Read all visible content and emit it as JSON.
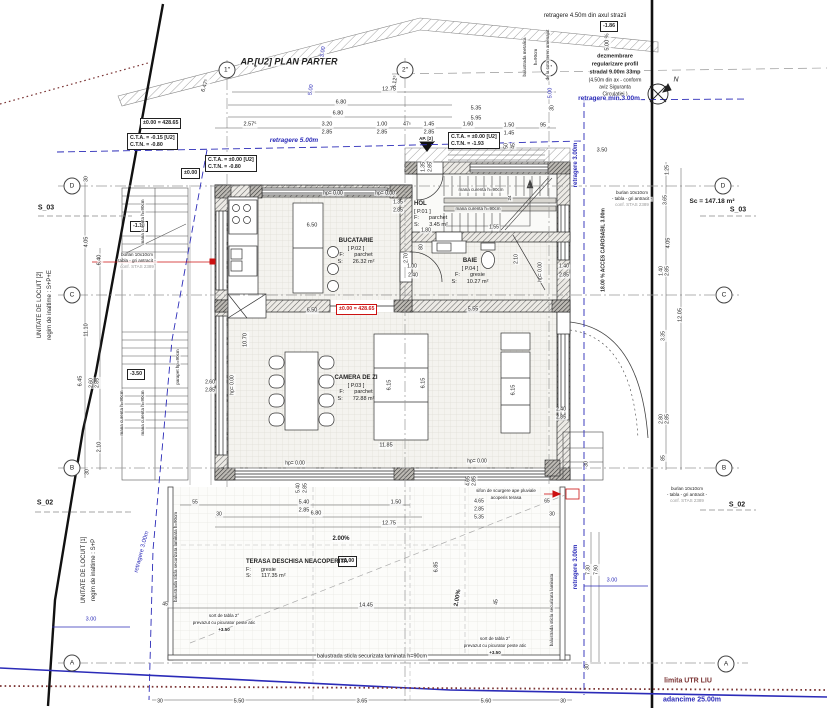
{
  "meta": {
    "width": 827,
    "height": 708
  },
  "colors": {
    "accent_blue": "#2b2bb8",
    "accent_red": "#cc1111",
    "limit_darkred": "#7a3333",
    "ink": "#222222"
  },
  "grid_bubbles": [
    {
      "t": "D",
      "x": 72,
      "y": 186
    },
    {
      "t": "C",
      "x": 72,
      "y": 295
    },
    {
      "t": "B",
      "x": 72,
      "y": 468
    },
    {
      "t": "A",
      "x": 72,
      "y": 663
    },
    {
      "t": "D",
      "x": 723,
      "y": 186
    },
    {
      "t": "C",
      "x": 724,
      "y": 295
    },
    {
      "t": "B",
      "x": 724,
      "y": 468
    },
    {
      "t": "A",
      "x": 726,
      "y": 664
    },
    {
      "t": "1″",
      "x": 227,
      "y": 70
    },
    {
      "t": "2″",
      "x": 405,
      "y": 70
    },
    {
      "t": "3″",
      "x": 549,
      "y": 68
    }
  ],
  "boxes": [
    {
      "x": 140,
      "y": 118,
      "lines": [
        "±0.00 = 428.65"
      ]
    },
    {
      "x": 127,
      "y": 133,
      "lines": [
        "C.T.A. = -0.15 [U2]",
        "C.T.N. = -0.80"
      ]
    },
    {
      "x": 205,
      "y": 155,
      "lines": [
        "C.T.A. = ±0.00 [U2]",
        "C.T.N. = -0.80"
      ]
    },
    {
      "x": 181,
      "y": 168,
      "lines": [
        "±0.00"
      ]
    },
    {
      "x": 448,
      "y": 132,
      "lines": [
        "C.T.A. = ±0.00 [U2]",
        "C.T.N. = -1.93"
      ]
    },
    {
      "x": 600,
      "y": 21,
      "lines": [
        "-1.86"
      ]
    },
    {
      "x": 336,
      "y": 304,
      "lines": [
        "±0.00 = 428.65"
      ],
      "red": true
    },
    {
      "x": 338,
      "y": 556,
      "lines": [
        "±0.00"
      ]
    },
    {
      "x": 130,
      "y": 221,
      "lines": [
        "-1.10"
      ]
    },
    {
      "x": 127,
      "y": 369,
      "lines": [
        "-3.50"
      ]
    }
  ],
  "rooms": [
    {
      "name": "BUCATARIE",
      "code": "[ P.02 ]",
      "f_label": "F:",
      "f_value": "parchet",
      "s_label": "S:",
      "s_value": "26.32 m²",
      "x": 356,
      "y": 238,
      "centered": true
    },
    {
      "name": "HOL",
      "code": "[ P.01 ]",
      "f_label": "F:",
      "f_value": "parchet",
      "s_label": "S:",
      "s_value": "3.45 m²",
      "x": 414,
      "y": 201,
      "centered": false
    },
    {
      "name": "BAIE",
      "code": "[ P.04 ]",
      "f_label": "F:",
      "f_value": "gresie",
      "s_label": "S:",
      "s_value": "10.27 m²",
      "x": 470,
      "y": 258,
      "centered": true
    },
    {
      "name": "CAMERA DE ZI",
      "code": "[ P.03 ]",
      "f_label": "F:",
      "f_value": "parchet",
      "s_label": "S:",
      "s_value": "72.88 m²",
      "x": 356,
      "y": 375,
      "centered": true
    },
    {
      "name": "TERASA DESCHISA NEACOPERITA",
      "code": "",
      "f_label": "F:",
      "f_value": "gresie",
      "s_label": "S:",
      "s_value": "117.35 m²",
      "x": 246,
      "y": 559,
      "centered": false
    }
  ],
  "labels": [
    {
      "t": "AP.[U2] PLAN PARTER",
      "x": 289,
      "y": 62,
      "s": 9,
      "b": 1,
      "i": 1,
      "n": "plan-title"
    },
    {
      "t": "retragere 4.50m din axul strazii",
      "x": 585,
      "y": 16,
      "s": 6,
      "n": "setback-street-label"
    },
    {
      "t": "5.00 %",
      "x": 608,
      "y": 42,
      "r": -90,
      "s": 5.5
    },
    {
      "t": "dezmembrare",
      "x": 615,
      "y": 57,
      "s": 5.5,
      "b": 1,
      "n": "note-dezmembrare"
    },
    {
      "t": "regularizare profil",
      "x": 615,
      "y": 65,
      "s": 5.5,
      "b": 1
    },
    {
      "t": "stradal 9.00m 33mp",
      "x": 615,
      "y": 73,
      "s": 5.5,
      "b": 1
    },
    {
      "t": "(4.50m din ax - conform",
      "x": 615,
      "y": 81,
      "s": 5
    },
    {
      "t": "aviz Siguranta",
      "x": 615,
      "y": 88,
      "s": 5
    },
    {
      "t": "Circulatiei )",
      "x": 615,
      "y": 95,
      "s": 5
    },
    {
      "t": "retragere min.3.00m",
      "x": 609,
      "y": 99,
      "s": 6.5,
      "b": 1,
      "c": "cb",
      "n": "setback-min-label"
    },
    {
      "t": "N",
      "x": 676,
      "y": 80,
      "s": 7,
      "i": 1,
      "n": "north-label"
    },
    {
      "t": "balustrada metalica",
      "x": 525,
      "y": 57,
      "r": -90,
      "s": 4.5
    },
    {
      "t": "h=90cm",
      "x": 536,
      "y": 57,
      "r": -90,
      "s": 4.5
    },
    {
      "t": "de la cota teren amenajat",
      "x": 548,
      "y": 55,
      "r": -90,
      "s": 4.5
    },
    {
      "t": "5.00",
      "x": 551,
      "y": 93,
      "r": -90,
      "s": 5.5,
      "c": "cb"
    },
    {
      "t": "retragere 5.00m",
      "x": 294,
      "y": 141,
      "s": 6.5,
      "b": 1,
      "i": 1,
      "c": "cb",
      "n": "setback-5m-label"
    },
    {
      "t": "6.47⁵",
      "x": 206,
      "y": 86,
      "r": -72,
      "s": 5.5
    },
    {
      "t": "3.00",
      "x": 324,
      "y": 52,
      "r": -80,
      "s": 5.5,
      "c": "cb"
    },
    {
      "t": "5.00",
      "x": 312,
      "y": 90,
      "r": -80,
      "s": 5.5,
      "c": "cb"
    },
    {
      "t": "5.12⁵",
      "x": 396,
      "y": 82,
      "r": -83,
      "s": 5.5
    },
    {
      "t": "12.75",
      "x": 389,
      "y": 90,
      "s": 5.5
    },
    {
      "t": "6.80",
      "x": 341,
      "y": 103,
      "s": 5.5
    },
    {
      "t": "6.80",
      "x": 338,
      "y": 114,
      "s": 5.5
    },
    {
      "t": "5.35",
      "x": 476,
      "y": 109,
      "s": 5.5
    },
    {
      "t": "5.95",
      "x": 476,
      "y": 119,
      "s": 5.5
    },
    {
      "t": "2.57⁵",
      "x": 250,
      "y": 125,
      "s": 5.5
    },
    {
      "t": "3.20",
      "x": 327,
      "y": 125,
      "s": 5.5
    },
    {
      "t": "2.85",
      "x": 327,
      "y": 133,
      "s": 5.5
    },
    {
      "t": "1.00",
      "x": 382,
      "y": 125,
      "s": 5.5
    },
    {
      "t": "2.85",
      "x": 382,
      "y": 133,
      "s": 5.5
    },
    {
      "t": "47⁵",
      "x": 407,
      "y": 125,
      "s": 5
    },
    {
      "t": "1.45",
      "x": 429,
      "y": 125,
      "s": 5.5
    },
    {
      "t": "2.85",
      "x": 429,
      "y": 133,
      "s": 5.5
    },
    {
      "t": "AP. [2]",
      "x": 426,
      "y": 139,
      "s": 4.5,
      "b": 1,
      "n": "entry-label"
    },
    {
      "t": "1.60",
      "x": 468,
      "y": 125,
      "s": 5.5
    },
    {
      "t": "1.50",
      "x": 509,
      "y": 126,
      "s": 5.5
    },
    {
      "t": "1.45",
      "x": 509,
      "y": 134,
      "s": 5.5
    },
    {
      "t": "95",
      "x": 543,
      "y": 126,
      "s": 5.5
    },
    {
      "t": "30",
      "x": 553,
      "y": 108,
      "r": -90,
      "s": 5
    },
    {
      "t": "50",
      "x": 507,
      "y": 146,
      "r": -90,
      "s": 5
    },
    {
      "t": "45",
      "x": 514,
      "y": 146,
      "r": -90,
      "s": 5
    },
    {
      "t": "3.50",
      "x": 602,
      "y": 151,
      "s": 5.5
    },
    {
      "t": "retragere 3.00m",
      "x": 576,
      "y": 165,
      "r": -90,
      "s": 6,
      "b": 1,
      "c": "cb",
      "n": "setback-3m-label"
    },
    {
      "t": "UNITATE DE LOCUIT [2]",
      "x": 40,
      "y": 305,
      "r": -90,
      "s": 6,
      "n": "unit2-label"
    },
    {
      "t": "regim de inaltime : S+P+E",
      "x": 50,
      "y": 305,
      "r": -90,
      "s": 6
    },
    {
      "t": "S_03",
      "x": 46,
      "y": 208,
      "s": 7,
      "b": 1,
      "n": "section-marker"
    },
    {
      "t": "S_02",
      "x": 45,
      "y": 503,
      "s": 7,
      "b": 1,
      "n": "section-marker"
    },
    {
      "t": "UNITATE DE LOCUIT [1]",
      "x": 84,
      "y": 570,
      "r": -90,
      "s": 6,
      "n": "unit1-label"
    },
    {
      "t": "regim de inaltime : S+P",
      "x": 94,
      "y": 570,
      "r": -90,
      "s": 6
    },
    {
      "t": "30",
      "x": 87,
      "y": 179,
      "r": -90,
      "s": 5
    },
    {
      "t": "4.05",
      "x": 87,
      "y": 242,
      "r": -90,
      "s": 5.5
    },
    {
      "t": "6.40",
      "x": 100,
      "y": 260,
      "r": -90,
      "s": 5.5
    },
    {
      "t": "11.10",
      "x": 87,
      "y": 330,
      "r": -90,
      "s": 5.5
    },
    {
      "t": "6.45",
      "x": 81,
      "y": 381,
      "r": -90,
      "s": 5.5
    },
    {
      "t": "2.60",
      "x": 92,
      "y": 383,
      "r": -90,
      "s": 5
    },
    {
      "t": "2.85",
      "x": 98,
      "y": 383,
      "r": -90,
      "s": 5
    },
    {
      "t": "2.10",
      "x": 100,
      "y": 447,
      "r": -90,
      "s": 5.5
    },
    {
      "t": "30",
      "x": 88,
      "y": 472,
      "r": -90,
      "s": 5
    },
    {
      "t": "retragere 3.00m",
      "x": 142,
      "y": 552,
      "r": -75,
      "s": 6,
      "c": "cb"
    },
    {
      "t": "3.00",
      "x": 91,
      "y": 620,
      "s": 5.5,
      "c": "cb"
    },
    {
      "t": "mana curenta h=90cm",
      "x": 143,
      "y": 222,
      "r": -90,
      "s": 4.5
    },
    {
      "t": "burlan 10x10cm",
      "x": 137,
      "y": 255,
      "s": 4.5
    },
    {
      "t": "tabla - gri antracit -",
      "x": 137,
      "y": 261,
      "s": 4.5
    },
    {
      "t": "conf. STAS 2389",
      "x": 137,
      "y": 267,
      "s": 4.5,
      "c": "cg"
    },
    {
      "t": "mana curenta h=90cm",
      "x": 122,
      "y": 413,
      "r": -90,
      "s": 4.5
    },
    {
      "t": "mana curenta h=90cm",
      "x": 143,
      "y": 413,
      "r": -90,
      "s": 4.5
    },
    {
      "t": "parapet hp=90cm",
      "x": 178,
      "y": 367,
      "r": -90,
      "s": 4.5
    },
    {
      "t": "2.60",
      "x": 210,
      "y": 383,
      "s": 5
    },
    {
      "t": "2.85",
      "x": 210,
      "y": 391,
      "s": 5
    },
    {
      "t": "hp= 0.00",
      "x": 333,
      "y": 194,
      "s": 5
    },
    {
      "t": "hp= 0.00",
      "x": 385,
      "y": 194,
      "s": 5
    },
    {
      "t": "1.35",
      "x": 398,
      "y": 203,
      "s": 5
    },
    {
      "t": "2.85",
      "x": 398,
      "y": 211,
      "s": 5
    },
    {
      "t": "1.35",
      "x": 424,
      "y": 167,
      "r": -90,
      "s": 5
    },
    {
      "t": "2.85",
      "x": 431,
      "y": 167,
      "r": -90,
      "s": 5
    },
    {
      "t": "6.50",
      "x": 312,
      "y": 226,
      "s": 5.5
    },
    {
      "t": "2.70",
      "x": 407,
      "y": 258,
      "r": -90,
      "s": 5
    },
    {
      "t": "mana curenta h=90cm",
      "x": 481,
      "y": 190,
      "s": 4.5
    },
    {
      "t": "mana curenta h=90cm",
      "x": 478,
      "y": 209,
      "s": 4.5
    },
    {
      "t": "24",
      "x": 510,
      "y": 198,
      "r": -90,
      "s": 4.5
    },
    {
      "t": "1.80",
      "x": 426,
      "y": 231,
      "s": 5
    },
    {
      "t": "1.55",
      "x": 494,
      "y": 228,
      "s": 5
    },
    {
      "t": "80",
      "x": 422,
      "y": 247,
      "r": -90,
      "s": 5
    },
    {
      "t": "1.00",
      "x": 412,
      "y": 267,
      "s": 5
    },
    {
      "t": "2.40",
      "x": 413,
      "y": 276,
      "s": 5
    },
    {
      "t": "2.10",
      "x": 517,
      "y": 259,
      "r": -90,
      "s": 5
    },
    {
      "t": "hp= 0.00",
      "x": 541,
      "y": 272,
      "r": -90,
      "s": 5
    },
    {
      "t": "1.40",
      "x": 564,
      "y": 267,
      "s": 5
    },
    {
      "t": "2.85",
      "x": 564,
      "y": 276,
      "s": 5
    },
    {
      "t": "5.55",
      "x": 473,
      "y": 310,
      "s": 5.5
    },
    {
      "t": "6.50",
      "x": 312,
      "y": 311,
      "s": 5.5
    },
    {
      "t": "10.70",
      "x": 246,
      "y": 340,
      "r": -90,
      "s": 5.5
    },
    {
      "t": "hp= 0.00",
      "x": 233,
      "y": 385,
      "r": -90,
      "s": 5
    },
    {
      "t": "6.15",
      "x": 390,
      "y": 385,
      "r": -90,
      "s": 5.5
    },
    {
      "t": "6.15",
      "x": 424,
      "y": 383,
      "r": -90,
      "s": 5.5
    },
    {
      "t": "6.15",
      "x": 514,
      "y": 390,
      "r": -90,
      "s": 5.5
    },
    {
      "t": "2.40",
      "x": 561,
      "y": 410,
      "s": 5
    },
    {
      "t": "2.85",
      "x": 561,
      "y": 418,
      "s": 5
    },
    {
      "t": "11.85",
      "x": 386,
      "y": 446,
      "s": 5.5
    },
    {
      "t": "hp= 0.00",
      "x": 295,
      "y": 464,
      "s": 5
    },
    {
      "t": "hp= 0.00",
      "x": 477,
      "y": 462,
      "s": 5
    },
    {
      "t": "18.00 %  ACCES CAROSABIL 3.00m",
      "x": 604,
      "y": 250,
      "r": -90,
      "s": 5,
      "b": 1,
      "n": "access-label"
    },
    {
      "t": "burlan 10x10cm",
      "x": 632,
      "y": 193,
      "s": 4.5
    },
    {
      "t": "- tabla - gri antracit -",
      "x": 632,
      "y": 199,
      "s": 4.5
    },
    {
      "t": "conf. STAS 2389",
      "x": 632,
      "y": 205,
      "s": 4.5,
      "c": "cg"
    },
    {
      "t": "Sc = 147.18 m²",
      "x": 712,
      "y": 202,
      "s": 6.5,
      "b": 1,
      "n": "built-area-label"
    },
    {
      "t": "S_03",
      "x": 738,
      "y": 210,
      "s": 7,
      "b": 1,
      "n": "section-marker"
    },
    {
      "t": "S_02",
      "x": 737,
      "y": 505,
      "s": 7,
      "b": 1,
      "n": "section-marker"
    },
    {
      "t": "burlan 10x10cm",
      "x": 687,
      "y": 489,
      "s": 4.5
    },
    {
      "t": "- tabla - gri antracit -",
      "x": 687,
      "y": 495,
      "s": 4.5
    },
    {
      "t": "conf. STAS 2389",
      "x": 687,
      "y": 501,
      "s": 4.5,
      "c": "cg"
    },
    {
      "t": "1.25",
      "x": 668,
      "y": 170,
      "r": -90,
      "s": 5
    },
    {
      "t": "3.65",
      "x": 666,
      "y": 200,
      "r": -90,
      "s": 5
    },
    {
      "t": "4.05",
      "x": 669,
      "y": 243,
      "r": -90,
      "s": 5.5
    },
    {
      "t": "1.40",
      "x": 662,
      "y": 271,
      "r": -90,
      "s": 5
    },
    {
      "t": "2.85",
      "x": 668,
      "y": 271,
      "r": -90,
      "s": 5
    },
    {
      "t": "12.05",
      "x": 681,
      "y": 315,
      "r": -90,
      "s": 5.5
    },
    {
      "t": "3.35",
      "x": 664,
      "y": 336,
      "r": -90,
      "s": 5
    },
    {
      "t": "2.80",
      "x": 662,
      "y": 419,
      "r": -90,
      "s": 5
    },
    {
      "t": "2.85",
      "x": 668,
      "y": 419,
      "r": -90,
      "s": 5
    },
    {
      "t": "85",
      "x": 664,
      "y": 458,
      "r": -90,
      "s": 5
    },
    {
      "t": "30",
      "x": 587,
      "y": 464,
      "r": -90,
      "s": 5
    },
    {
      "t": "retragere 3.00m",
      "x": 576,
      "y": 567,
      "r": -90,
      "s": 6,
      "b": 1,
      "c": "cb"
    },
    {
      "t": "3.00",
      "x": 612,
      "y": 581,
      "s": 5.5,
      "c": "cb"
    },
    {
      "t": "7.30",
      "x": 589,
      "y": 570,
      "r": -90,
      "s": 5
    },
    {
      "t": "7.90",
      "x": 597,
      "y": 570,
      "r": -90,
      "s": 5
    },
    {
      "t": "30",
      "x": 588,
      "y": 667,
      "r": -90,
      "s": 5
    },
    {
      "t": "limita UTR LIU",
      "x": 688,
      "y": 681,
      "s": 7,
      "b": 1,
      "c": "cdr",
      "n": "limit-utr-label"
    },
    {
      "t": "adancime 25.00m",
      "x": 692,
      "y": 700,
      "s": 7,
      "b": 1,
      "c": "cb",
      "n": "depth-label"
    },
    {
      "t": "5.40",
      "x": 299,
      "y": 488,
      "r": -90,
      "s": 5
    },
    {
      "t": "2.85",
      "x": 306,
      "y": 488,
      "r": -90,
      "s": 5
    },
    {
      "t": "sifon de scurgere ape pluviale",
      "x": 506,
      "y": 491,
      "s": 4.5,
      "n": "drain-note"
    },
    {
      "t": "acoperis terasa",
      "x": 506,
      "y": 498,
      "s": 4.5
    },
    {
      "t": "55",
      "x": 195,
      "y": 503,
      "s": 5
    },
    {
      "t": "5.40",
      "x": 304,
      "y": 503,
      "s": 5.5
    },
    {
      "t": "2.85",
      "x": 304,
      "y": 511,
      "s": 5.5
    },
    {
      "t": "1.50",
      "x": 396,
      "y": 503,
      "s": 5.5
    },
    {
      "t": "30",
      "x": 219,
      "y": 515,
      "s": 5
    },
    {
      "t": "6.80",
      "x": 316,
      "y": 514,
      "s": 5.5
    },
    {
      "t": "12.75",
      "x": 389,
      "y": 524,
      "s": 5.5
    },
    {
      "t": "4.65",
      "x": 469,
      "y": 481,
      "r": -90,
      "s": 5
    },
    {
      "t": "2.85",
      "x": 475,
      "y": 481,
      "r": -90,
      "s": 5
    },
    {
      "t": "4.65",
      "x": 479,
      "y": 502,
      "s": 5
    },
    {
      "t": "2.85",
      "x": 479,
      "y": 510,
      "s": 5
    },
    {
      "t": "5.35",
      "x": 479,
      "y": 518,
      "s": 5
    },
    {
      "t": "65",
      "x": 547,
      "y": 502,
      "s": 5
    },
    {
      "t": "30",
      "x": 552,
      "y": 515,
      "s": 5
    },
    {
      "t": "2.00%",
      "x": 341,
      "y": 539,
      "s": 6,
      "b": 1
    },
    {
      "t": "2.00%",
      "x": 458,
      "y": 598,
      "r": -80,
      "s": 6,
      "b": 1
    },
    {
      "t": "6.85",
      "x": 437,
      "y": 567,
      "r": -90,
      "s": 5.5
    },
    {
      "t": "14.45",
      "x": 366,
      "y": 606,
      "s": 5.5
    },
    {
      "t": "45",
      "x": 165,
      "y": 605,
      "s": 5
    },
    {
      "t": "45",
      "x": 497,
      "y": 602,
      "r": -90,
      "s": 5
    },
    {
      "t": "balustrada sticla securizata laminata h=90cm",
      "x": 176,
      "y": 557,
      "r": -90,
      "s": 4.5,
      "n": "railing-note"
    },
    {
      "t": "balustrada sticla securizata laminata",
      "x": 552,
      "y": 610,
      "r": -90,
      "s": 4.5,
      "n": "railing-note"
    },
    {
      "t": "sort de tabla 2°",
      "x": 224,
      "y": 616,
      "s": 4.5
    },
    {
      "t": "prevazut cu picurator peste atic",
      "x": 224,
      "y": 623,
      "s": 4.5
    },
    {
      "t": "+3.50",
      "x": 224,
      "y": 630,
      "s": 4.5,
      "b": 1
    },
    {
      "t": "sort de tabla 2°",
      "x": 495,
      "y": 639,
      "s": 4.5
    },
    {
      "t": "prevazut cu picurator peste atic",
      "x": 495,
      "y": 646,
      "s": 4.5
    },
    {
      "t": "+3.50",
      "x": 495,
      "y": 653,
      "s": 4.5,
      "b": 1
    },
    {
      "t": "balustrada sticla securizata laminata h=90cm",
      "x": 372,
      "y": 657,
      "s": 5.5,
      "n": "railing-note"
    },
    {
      "t": "30",
      "x": 160,
      "y": 702,
      "s": 5
    },
    {
      "t": "5.50",
      "x": 239,
      "y": 702,
      "s": 5.5
    },
    {
      "t": "3.65",
      "x": 362,
      "y": 702,
      "s": 5.5
    },
    {
      "t": "5.60",
      "x": 486,
      "y": 702,
      "s": 5.5
    },
    {
      "t": "30",
      "x": 563,
      "y": 702,
      "s": 5
    }
  ]
}
